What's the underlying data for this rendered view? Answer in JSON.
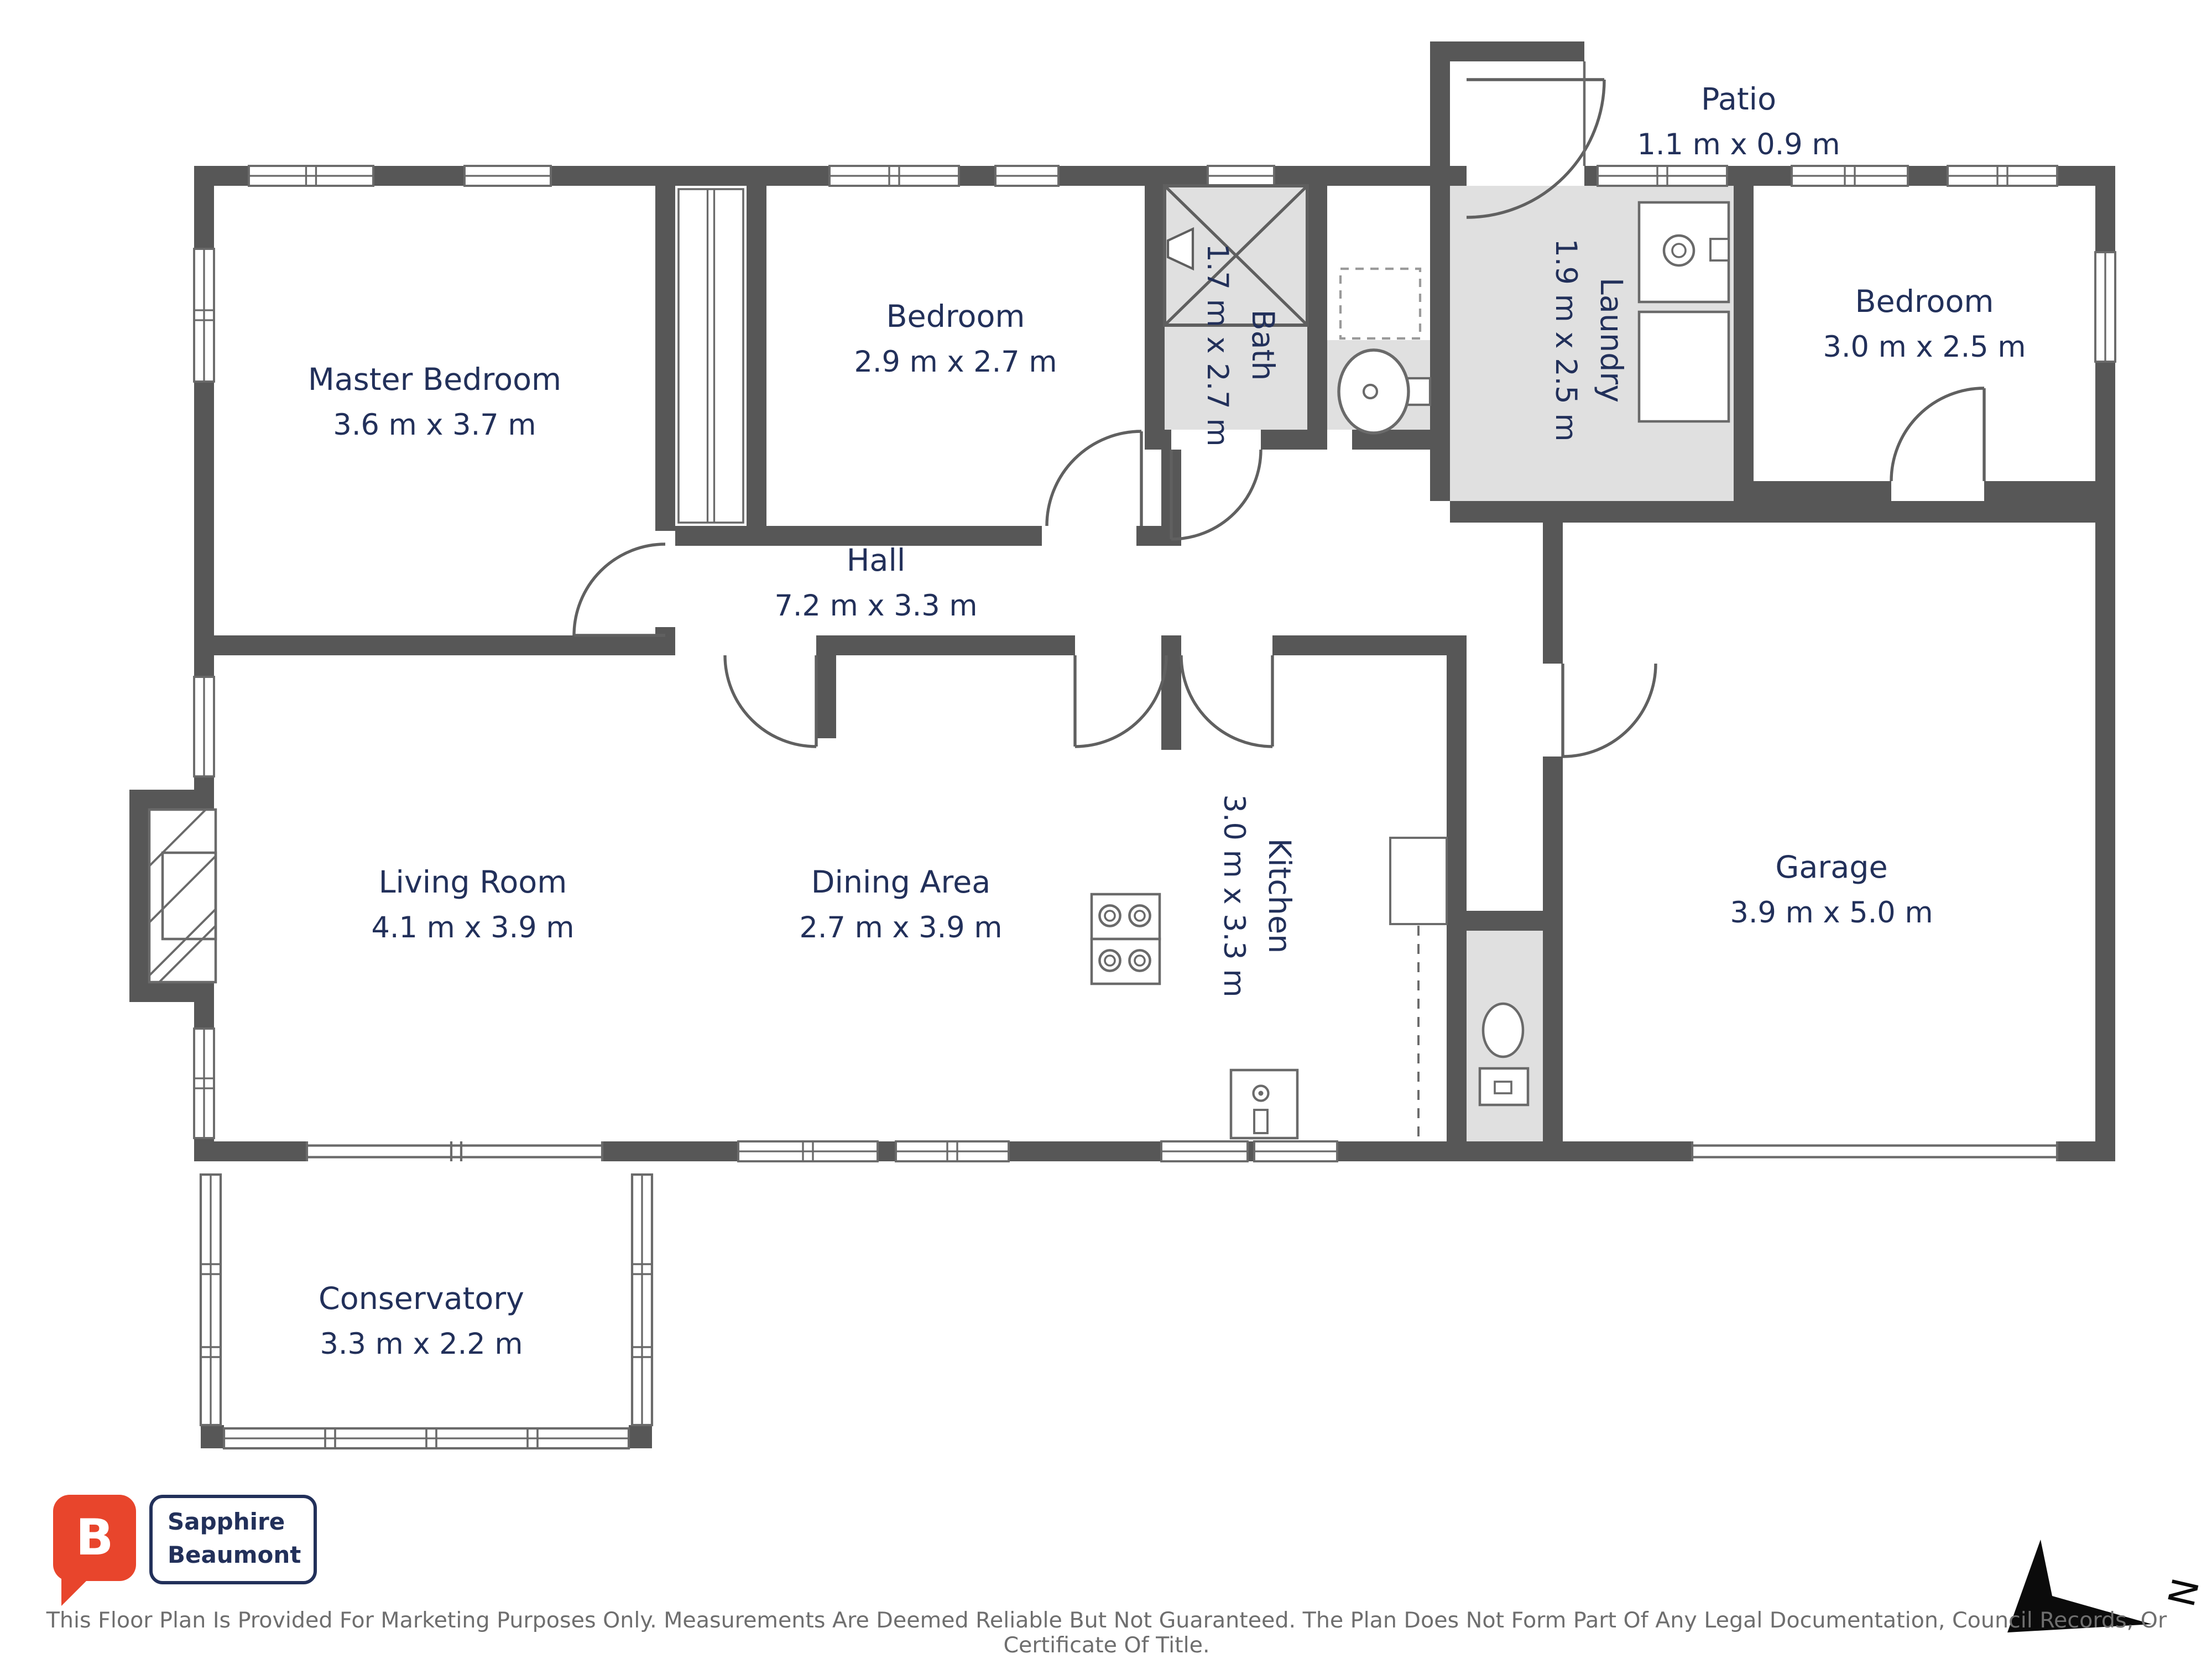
{
  "plan": {
    "rooms": {
      "master_bedroom": {
        "name": "Master Bedroom",
        "dimensions": "3.6 m x 3.7 m"
      },
      "bedroom_2": {
        "name": "Bedroom",
        "dimensions": "2.9 m x 2.7 m"
      },
      "bath": {
        "name": "Bath",
        "dimensions": "1.7 m x 2.7 m"
      },
      "laundry": {
        "name": "Laundry",
        "dimensions": "1.9 m x 2.5 m"
      },
      "patio": {
        "name": "Patio",
        "dimensions": "1.1 m x 0.9 m"
      },
      "bedroom_3": {
        "name": "Bedroom",
        "dimensions": "3.0 m x 2.5 m"
      },
      "hall": {
        "name": "Hall",
        "dimensions": "7.2 m x 3.3 m"
      },
      "living_room": {
        "name": "Living Room",
        "dimensions": "4.1 m x 3.9 m"
      },
      "dining_area": {
        "name": "Dining Area",
        "dimensions": "2.7 m x 3.9 m"
      },
      "kitchen": {
        "name": "Kitchen",
        "dimensions": "3.0 m x 3.3 m"
      },
      "garage": {
        "name": "Garage",
        "dimensions": "3.9 m x 5.0 m"
      },
      "conservatory": {
        "name": "Conservatory",
        "dimensions": "3.3 m x 2.2 m"
      }
    },
    "compass": {
      "label": "N"
    },
    "symbols": [
      "shower",
      "wash-basin",
      "toilet",
      "washing-machine",
      "cooktop",
      "kitchen-sink",
      "fireplace",
      "wardrobe",
      "door-swing",
      "window"
    ]
  },
  "branding": {
    "logo_monogram": "B",
    "company_name_line1": "Sapphire",
    "company_name_line2": "Beaumont"
  },
  "footer": {
    "disclaimer": "This Floor Plan Is Provided For Marketing Purposes Only. Measurements Are Deemed Reliable But Not Guaranteed. The Plan Does Not Form Part Of Any Legal Documentation, Council Records, Or Certificate Of Title."
  },
  "colors": {
    "wall": "#575757",
    "room_shading": "#e0e0e0",
    "label_text": "#22305a",
    "logo_red": "#e8452c",
    "line": "#666666"
  }
}
